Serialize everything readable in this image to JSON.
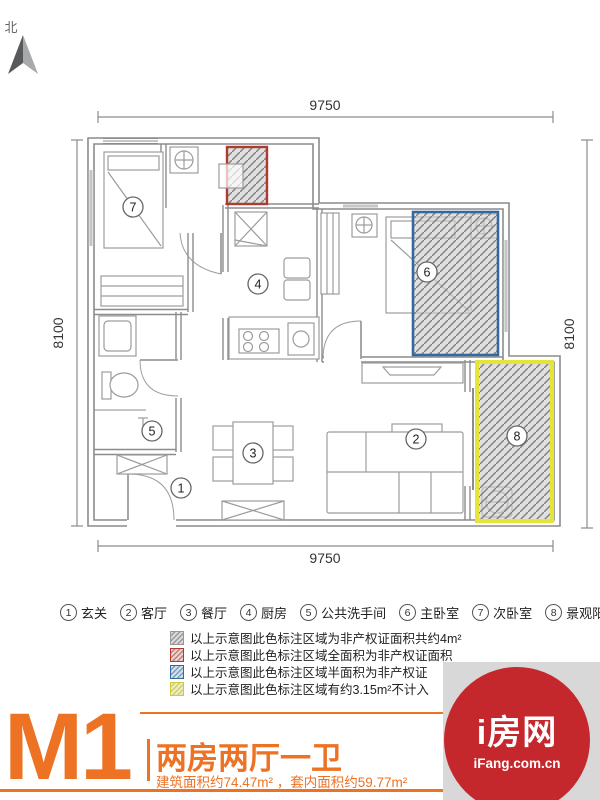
{
  "compass": {
    "north": "北"
  },
  "dimensions": {
    "top": "9750",
    "bottom": "9750",
    "left": "8100",
    "right": "8100"
  },
  "rooms": [
    {
      "num": "1",
      "label": "玄关"
    },
    {
      "num": "2",
      "label": "客厅"
    },
    {
      "num": "3",
      "label": "餐厅"
    },
    {
      "num": "4",
      "label": "厨房"
    },
    {
      "num": "5",
      "label": "公共洗手间"
    },
    {
      "num": "6",
      "label": "主卧室"
    },
    {
      "num": "7",
      "label": "次卧室"
    },
    {
      "num": "8",
      "label": "景观阳台"
    }
  ],
  "legend": {
    "items": [
      {
        "color": "#9b9b9b",
        "text": "以上示意图此色标注区域为非产权证面积共约4m²"
      },
      {
        "color": "#ae3b32",
        "text": "以上示意图此色标注区域全面积为非产权证面积"
      },
      {
        "color": "#33699f",
        "text": "以上示意图此色标注区域半面积为非产权证"
      },
      {
        "color": "#ddd93a",
        "text": "以上示意图此色标注区域有约3.15m²不计入"
      }
    ]
  },
  "footer": {
    "unit_code": "M1",
    "unit_type": "两房两厅一卫",
    "area_info": "建筑面积约74.47m² ，套内面积约59.77m²"
  },
  "logo": {
    "brand": "i房网",
    "domain": "iFang.com.cn"
  },
  "colors": {
    "accent": "#ed7224",
    "logo_red": "#c4282d",
    "red_zone": "#ae3b32",
    "blue_zone": "#33699f",
    "yellow_zone": "#e6e339"
  }
}
